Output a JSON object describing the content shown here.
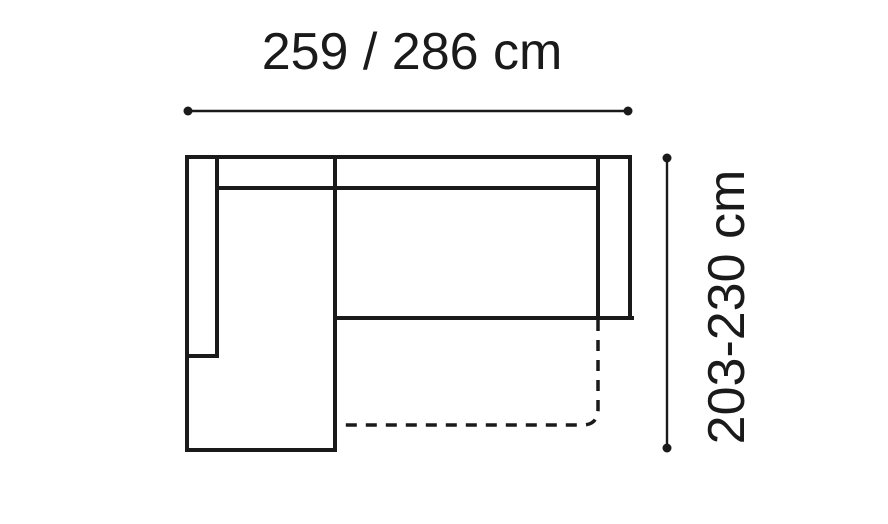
{
  "diagram": {
    "width_label": "259 / 286 cm",
    "height_label": "203-230 cm",
    "colors": {
      "ink": "#1a1a1a",
      "background": "#ffffff"
    }
  }
}
